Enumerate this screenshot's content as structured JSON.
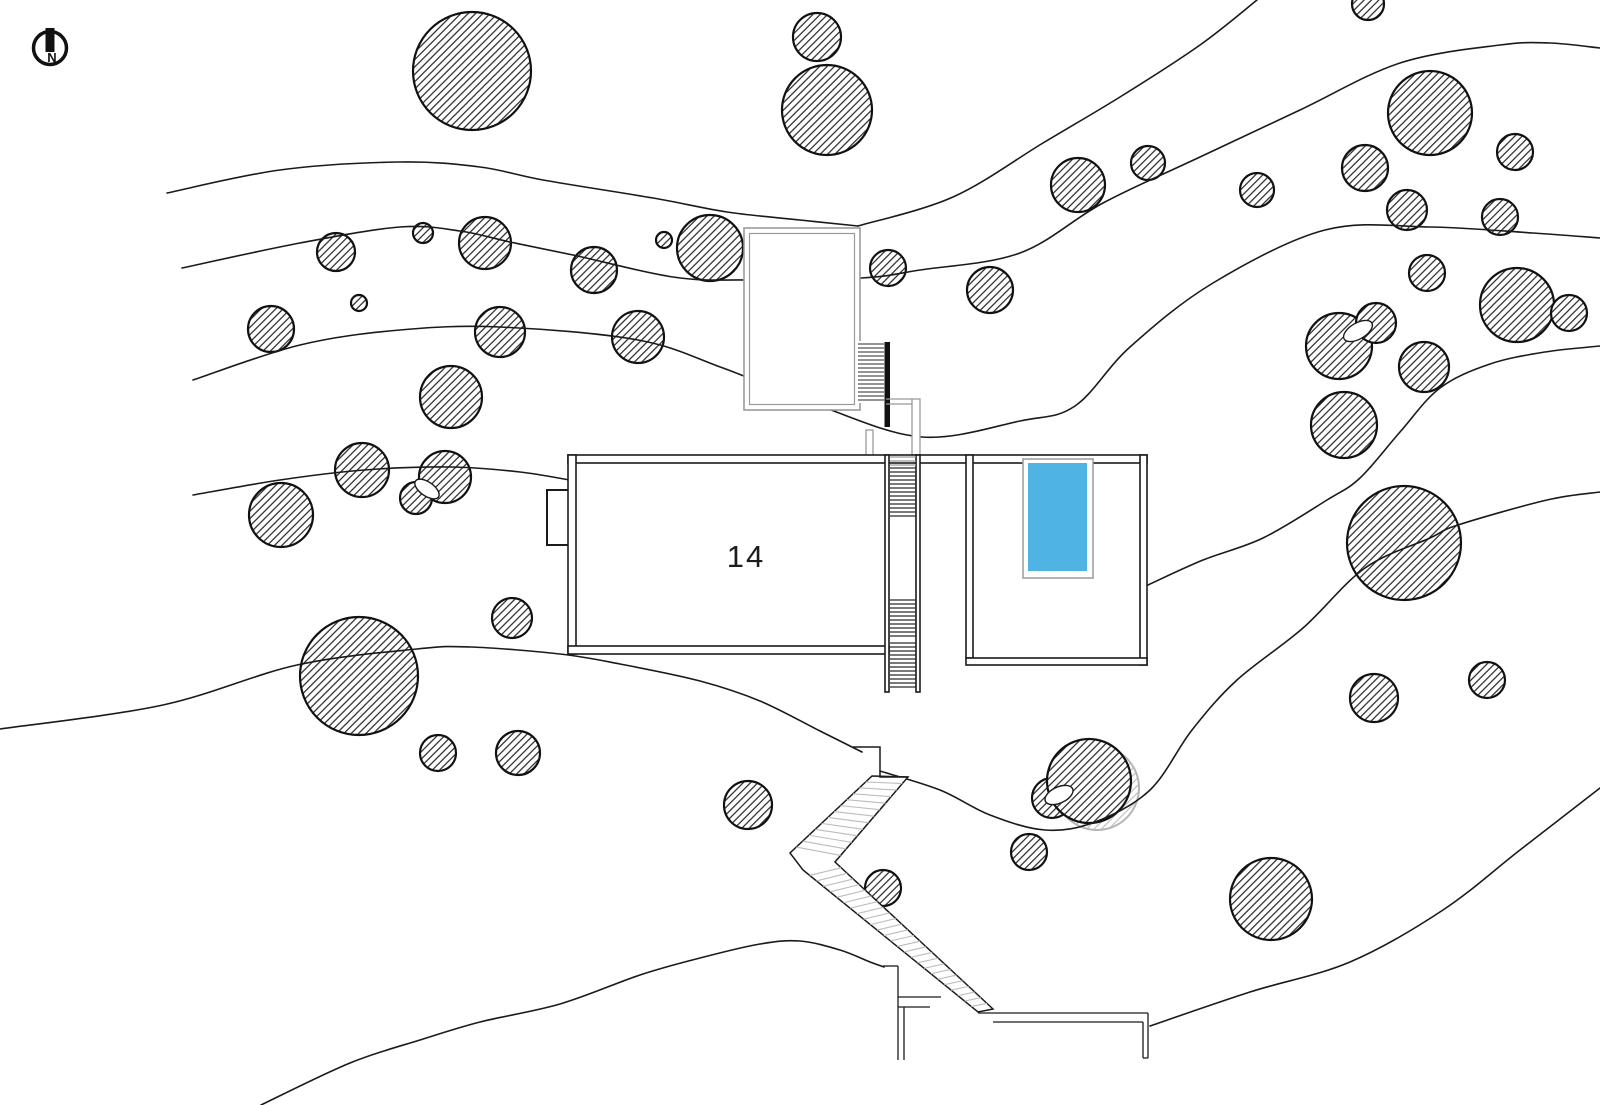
{
  "canvas": {
    "w": 1600,
    "h": 1105,
    "bg": "#ffffff"
  },
  "palette": {
    "ink": "#1a1a1a",
    "tree_stroke": "#111111",
    "gray": "#9a9a9a",
    "tread_light": "#bcbcbc",
    "tread_dark": "#2a2a2a",
    "ghost": "#b5b5b5",
    "pool_water": "#4fb3e3",
    "pool_rim": "#9a9a9a"
  },
  "north_arrow": {
    "label": "N",
    "cx": 50,
    "cy": 48,
    "r": 16.5,
    "ring_width": 3.5,
    "bar": {
      "x": 45.5,
      "y": 28,
      "w": 9,
      "h": 24
    }
  },
  "site_label": {
    "text": "14",
    "x": 746,
    "y": 567,
    "font_size": 31
  },
  "trees": [
    [
      472,
      71,
      59
    ],
    [
      817,
      37,
      24
    ],
    [
      827,
      110,
      45
    ],
    [
      1078,
      185,
      27
    ],
    [
      1148,
      163,
      17
    ],
    [
      1368,
      4,
      16
    ],
    [
      1430,
      113,
      42
    ],
    [
      1257,
      190,
      17
    ],
    [
      1365,
      168,
      23
    ],
    [
      1407,
      210,
      20
    ],
    [
      1515,
      152,
      18
    ],
    [
      1500,
      217,
      18
    ],
    [
      1427,
      273,
      18
    ],
    [
      1517,
      305,
      37
    ],
    [
      1569,
      313,
      18
    ],
    [
      336,
      252,
      19
    ],
    [
      423,
      233,
      10
    ],
    [
      485,
      243,
      26
    ],
    [
      594,
      270,
      23
    ],
    [
      664,
      240,
      8
    ],
    [
      710,
      248,
      33
    ],
    [
      888,
      268,
      18
    ],
    [
      990,
      290,
      23
    ],
    [
      271,
      329,
      23
    ],
    [
      359,
      303,
      8
    ],
    [
      500,
      332,
      25
    ],
    [
      638,
      337,
      26
    ],
    [
      451,
      397,
      31
    ],
    [
      362,
      470,
      27
    ],
    [
      445,
      477,
      26
    ],
    [
      416,
      498,
      16
    ],
    [
      281,
      515,
      32
    ],
    [
      512,
      618,
      20
    ],
    [
      359,
      676,
      59
    ],
    [
      438,
      753,
      18
    ],
    [
      518,
      753,
      22
    ],
    [
      748,
      805,
      24
    ],
    [
      883,
      888,
      18
    ],
    [
      1029,
      852,
      18
    ],
    [
      1052,
      798,
      20
    ],
    [
      1089,
      781,
      42
    ],
    [
      1339,
      346,
      33
    ],
    [
      1376,
      323,
      20
    ],
    [
      1424,
      367,
      25
    ],
    [
      1344,
      425,
      33
    ],
    [
      1404,
      543,
      57
    ],
    [
      1271,
      899,
      41
    ],
    [
      1374,
      698,
      24
    ],
    [
      1487,
      680,
      18
    ]
  ],
  "ghost_trees": [
    [
      1097,
      788,
      42
    ]
  ],
  "lenses": [
    {
      "cx": 427,
      "cy": 489,
      "rx": 7,
      "ry": 14,
      "rot": -55
    },
    {
      "cx": 1358,
      "cy": 331,
      "rx": 8,
      "ry": 16,
      "rot": 60
    },
    {
      "cx": 1059,
      "cy": 795,
      "rx": 8,
      "ry": 15,
      "rot": 65
    }
  ],
  "contours": [
    {
      "points": [
        [
          167,
          193
        ],
        [
          280,
          170
        ],
        [
          400,
          162
        ],
        [
          480,
          167
        ],
        [
          543,
          180
        ],
        [
          653,
          198
        ],
        [
          727,
          212
        ],
        [
          800,
          220
        ],
        [
          858,
          226
        ]
      ]
    },
    {
      "points": [
        [
          858,
          226
        ],
        [
          953,
          197
        ],
        [
          1043,
          143
        ],
        [
          1120,
          97
        ],
        [
          1200,
          45
        ],
        [
          1257,
          0
        ]
      ]
    },
    {
      "points": [
        [
          182,
          268
        ],
        [
          300,
          243
        ],
        [
          400,
          227
        ],
        [
          460,
          231
        ],
        [
          510,
          242
        ],
        [
          573,
          255
        ],
        [
          673,
          277
        ],
        [
          745,
          280
        ],
        [
          861,
          278
        ],
        [
          920,
          270
        ],
        [
          1020,
          253
        ],
        [
          1103,
          203
        ],
        [
          1200,
          157
        ],
        [
          1300,
          110
        ],
        [
          1400,
          63
        ],
        [
          1500,
          45
        ],
        [
          1550,
          43
        ],
        [
          1600,
          48
        ]
      ]
    },
    {
      "points": [
        [
          193,
          380
        ],
        [
          300,
          345
        ],
        [
          400,
          330
        ],
        [
          500,
          327
        ],
        [
          638,
          340
        ],
        [
          723,
          368
        ],
        [
          820,
          406
        ],
        [
          922,
          437
        ],
        [
          1020,
          421
        ],
        [
          1075,
          406
        ],
        [
          1130,
          347
        ],
        [
          1213,
          283
        ],
        [
          1325,
          230
        ],
        [
          1430,
          227
        ],
        [
          1533,
          233
        ],
        [
          1600,
          238
        ]
      ]
    },
    {
      "points": [
        [
          193,
          495
        ],
        [
          280,
          480
        ],
        [
          364,
          470
        ],
        [
          450,
          467
        ],
        [
          520,
          472
        ],
        [
          575,
          481
        ]
      ]
    },
    {
      "points": [
        [
          0,
          729
        ],
        [
          163,
          705
        ],
        [
          297,
          665
        ],
        [
          417,
          649
        ],
        [
          471,
          647
        ],
        [
          560,
          654
        ],
        [
          620,
          664
        ],
        [
          700,
          681
        ],
        [
          760,
          701
        ],
        [
          820,
          731
        ],
        [
          862,
          752
        ]
      ]
    },
    {
      "points": [
        [
          261,
          1105
        ],
        [
          350,
          1063
        ],
        [
          420,
          1040
        ],
        [
          480,
          1022
        ],
        [
          560,
          1004
        ],
        [
          640,
          975
        ],
        [
          700,
          958
        ],
        [
          760,
          944
        ],
        [
          800,
          941
        ],
        [
          840,
          950
        ],
        [
          870,
          962
        ],
        [
          884,
          967
        ]
      ]
    },
    {
      "points": [
        [
          880,
          771
        ],
        [
          940,
          790
        ],
        [
          990,
          815
        ],
        [
          1045,
          830
        ],
        [
          1095,
          822
        ],
        [
          1150,
          790
        ],
        [
          1192,
          730
        ],
        [
          1237,
          680
        ],
        [
          1303,
          628
        ],
        [
          1365,
          568
        ],
        [
          1430,
          538
        ],
        [
          1458,
          525
        ],
        [
          1547,
          500
        ],
        [
          1600,
          492
        ]
      ]
    },
    {
      "points": [
        [
          1148,
          585
        ],
        [
          1203,
          560
        ],
        [
          1263,
          538
        ],
        [
          1327,
          500
        ],
        [
          1360,
          478
        ],
        [
          1400,
          432
        ],
        [
          1440,
          388
        ],
        [
          1490,
          364
        ],
        [
          1545,
          352
        ],
        [
          1600,
          346
        ]
      ]
    },
    {
      "points": [
        [
          1150,
          1026
        ],
        [
          1250,
          992
        ],
        [
          1350,
          962
        ],
        [
          1443,
          910
        ],
        [
          1520,
          850
        ],
        [
          1600,
          788
        ]
      ]
    }
  ],
  "deck": {
    "outer": {
      "x": 744,
      "y": 228,
      "w": 116,
      "h": 182
    },
    "inner": {
      "x": 749.5,
      "y": 233.5,
      "w": 105,
      "h": 171
    }
  },
  "deck_stairs": {
    "x1": 858,
    "x2": 884,
    "y1": 344,
    "y2": 400,
    "step": 4,
    "bar": {
      "x": 884.5,
      "y": 342,
      "w": 5.5,
      "h": 85
    }
  },
  "gray_paths": {
    "rects": [
      {
        "x": 912,
        "y": 399,
        "w": 8,
        "h": 56
      },
      {
        "x": 866,
        "y": 430,
        "w": 7,
        "h": 27
      }
    ],
    "lines": [
      [
        [
          886,
          399
        ],
        [
          912,
          399
        ]
      ],
      [
        [
          886,
          404
        ],
        [
          912,
          404
        ]
      ]
    ]
  },
  "bump": {
    "x": 547,
    "y": 490,
    "w": 25,
    "h": 55
  },
  "walls": [
    {
      "x": 568,
      "y": 455,
      "w": 579,
      "h": 8
    },
    {
      "x": 568,
      "y": 455,
      "w": 8,
      "h": 199
    },
    {
      "x": 568,
      "y": 646,
      "w": 321,
      "h": 8
    },
    {
      "x": 885,
      "y": 455,
      "w": 4,
      "h": 237
    },
    {
      "x": 916,
      "y": 455,
      "w": 4,
      "h": 237
    },
    {
      "x": 966,
      "y": 455,
      "w": 7,
      "h": 203
    },
    {
      "x": 1140,
      "y": 455,
      "w": 7,
      "h": 210
    },
    {
      "x": 966,
      "y": 658,
      "w": 181,
      "h": 7
    }
  ],
  "channel_treads": {
    "x1": 890,
    "x2": 916,
    "step": 4,
    "groups": [
      {
        "y1": 457,
        "y2": 466,
        "dark": false
      },
      {
        "y1": 468,
        "y2": 518,
        "dark": true
      },
      {
        "y1": 600,
        "y2": 637,
        "dark": true
      },
      {
        "y1": 643,
        "y2": 690,
        "dark": true
      }
    ]
  },
  "switchback": {
    "outline": [
      [
        872,
        776
      ],
      [
        908,
        777
      ],
      [
        835,
        862
      ],
      [
        993,
        1009
      ],
      [
        978,
        1012
      ],
      [
        803,
        870
      ],
      [
        790,
        853
      ]
    ],
    "notch": [
      [
        853,
        747
      ],
      [
        880,
        747
      ],
      [
        880,
        777
      ],
      [
        908,
        777
      ]
    ],
    "flights": [
      {
        "a": [
          [
            872,
            776
          ],
          [
            790,
            853
          ]
        ],
        "b": [
          [
            908,
            777
          ],
          [
            835,
            862
          ]
        ],
        "n": 13
      },
      {
        "a": [
          [
            803,
            870
          ],
          [
            978,
            1012
          ]
        ],
        "b": [
          [
            835,
            862
          ],
          [
            993,
            1009
          ]
        ],
        "n": 26
      }
    ]
  },
  "walkway": {
    "segments": [
      [
        [
          978,
          1013
        ],
        [
          1148,
          1013
        ]
      ],
      [
        [
          1148,
          1013
        ],
        [
          1148,
          1058
        ]
      ],
      [
        [
          993,
          1022
        ],
        [
          1143,
          1022
        ]
      ],
      [
        [
          1143,
          1022
        ],
        [
          1143,
          1058
        ]
      ],
      [
        [
          1143,
          1058
        ],
        [
          1148,
          1058
        ]
      ],
      [
        [
          883,
          966
        ],
        [
          898,
          966
        ]
      ],
      [
        [
          898,
          966
        ],
        [
          898,
          1060
        ]
      ],
      [
        [
          898,
          997
        ],
        [
          941,
          997
        ]
      ],
      [
        [
          898,
          1007
        ],
        [
          930,
          1007
        ]
      ],
      [
        [
          904,
          1007
        ],
        [
          904,
          1060
        ]
      ]
    ]
  },
  "pool": {
    "basin": {
      "x": 1023,
      "y": 459,
      "w": 70,
      "h": 119
    },
    "water": {
      "x": 1028,
      "y": 463,
      "w": 59,
      "h": 108
    }
  }
}
